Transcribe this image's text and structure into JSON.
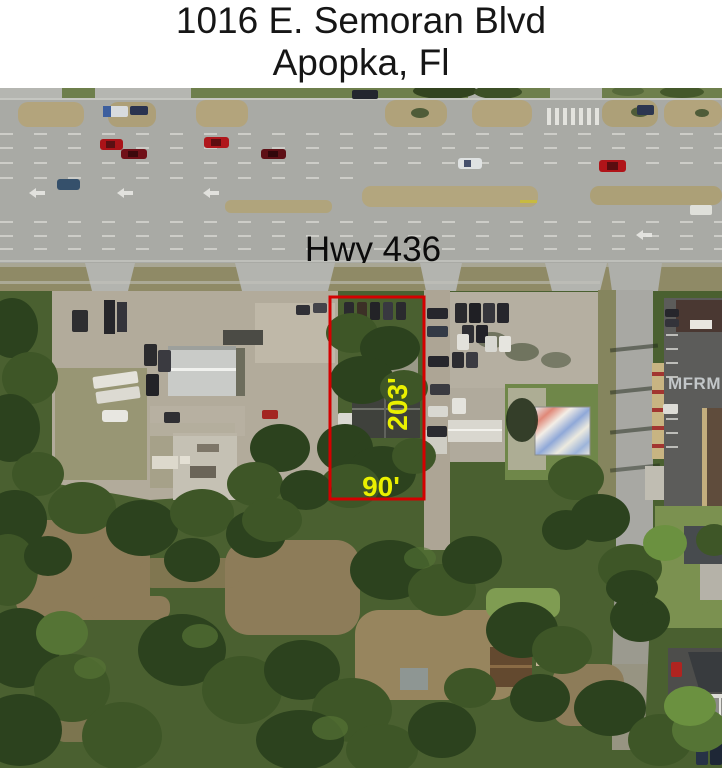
{
  "header": {
    "title_line1": "1016 E. Semoran Blvd",
    "title_line2": "Apopka, Fl"
  },
  "map": {
    "road_label": "Hwy 436",
    "watermark": "MFRMLS",
    "property": {
      "depth_label": "203'",
      "width_label": "90'"
    },
    "colors": {
      "boundary": "#d40000",
      "dimension_text": "#eaf000",
      "road_label_text": "#0b0b0b",
      "watermark_text": "#d4d9dc"
    }
  }
}
